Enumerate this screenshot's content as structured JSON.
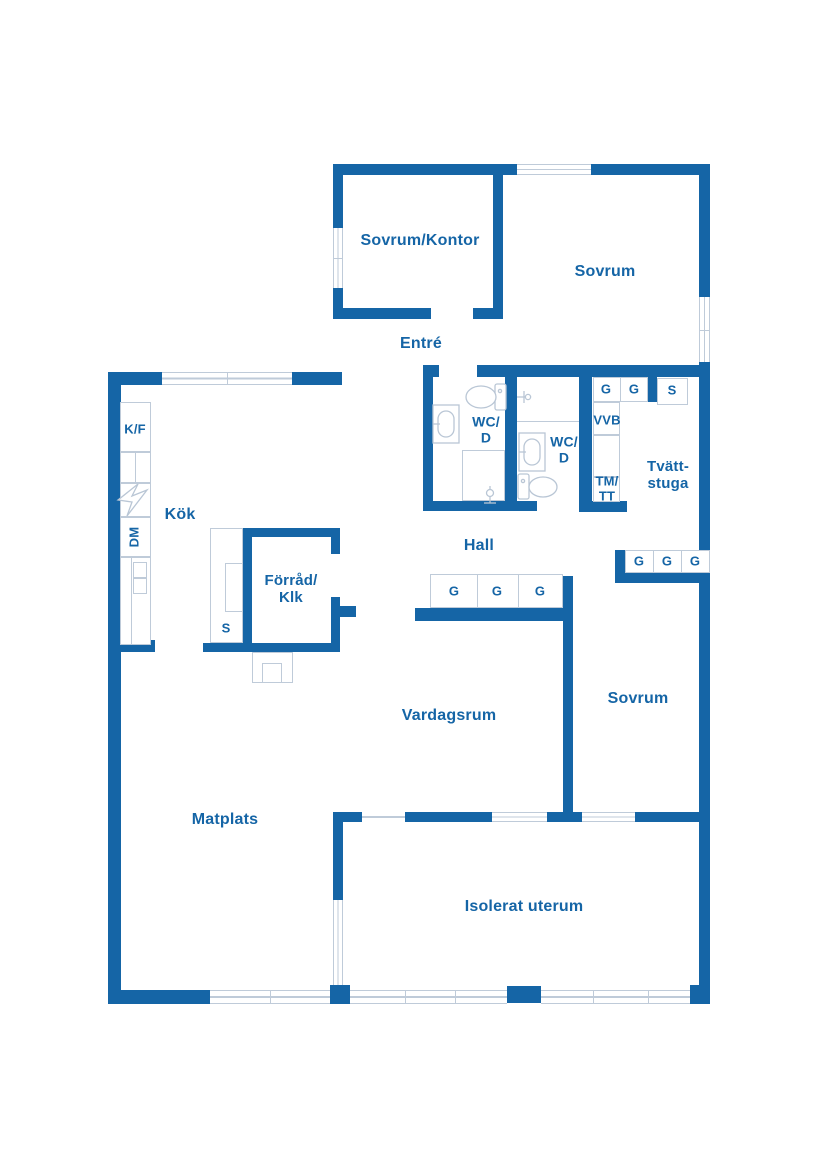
{
  "plan": {
    "title": "Floor plan",
    "colors": {
      "wall": "#1565a6",
      "label_text": "#1565a6",
      "thin_line": "#bfcbd9",
      "background": "#ffffff"
    },
    "rooms": [
      {
        "id": "sovrum-kontor",
        "label": "Sovrum/Kontor"
      },
      {
        "id": "sovrum-top",
        "label": "Sovrum"
      },
      {
        "id": "entre",
        "label": "Entré"
      },
      {
        "id": "wc-d-1",
        "label": "WC/\nD"
      },
      {
        "id": "wc-d-2",
        "label": "WC/\nD"
      },
      {
        "id": "hall",
        "label": "Hall"
      },
      {
        "id": "kok",
        "label": "Kök"
      },
      {
        "id": "forrad-klk",
        "label": "Förråd/\nKlk"
      },
      {
        "id": "tvattstuga",
        "label": "Tvätt-\nstuga"
      },
      {
        "id": "sovrum-bottom",
        "label": "Sovrum"
      },
      {
        "id": "vardagsrum",
        "label": "Vardagsrum"
      },
      {
        "id": "matplats",
        "label": "Matplats"
      },
      {
        "id": "isolerat-uterum",
        "label": "Isolerat uterum"
      }
    ],
    "fixtures": {
      "fridge_freezer": "K/F",
      "dishwasher": "DM",
      "water_heater": "VVB",
      "washer_dryer": "TM/\nTT",
      "wardrobe": "G",
      "cleaning_closet": "S"
    }
  }
}
